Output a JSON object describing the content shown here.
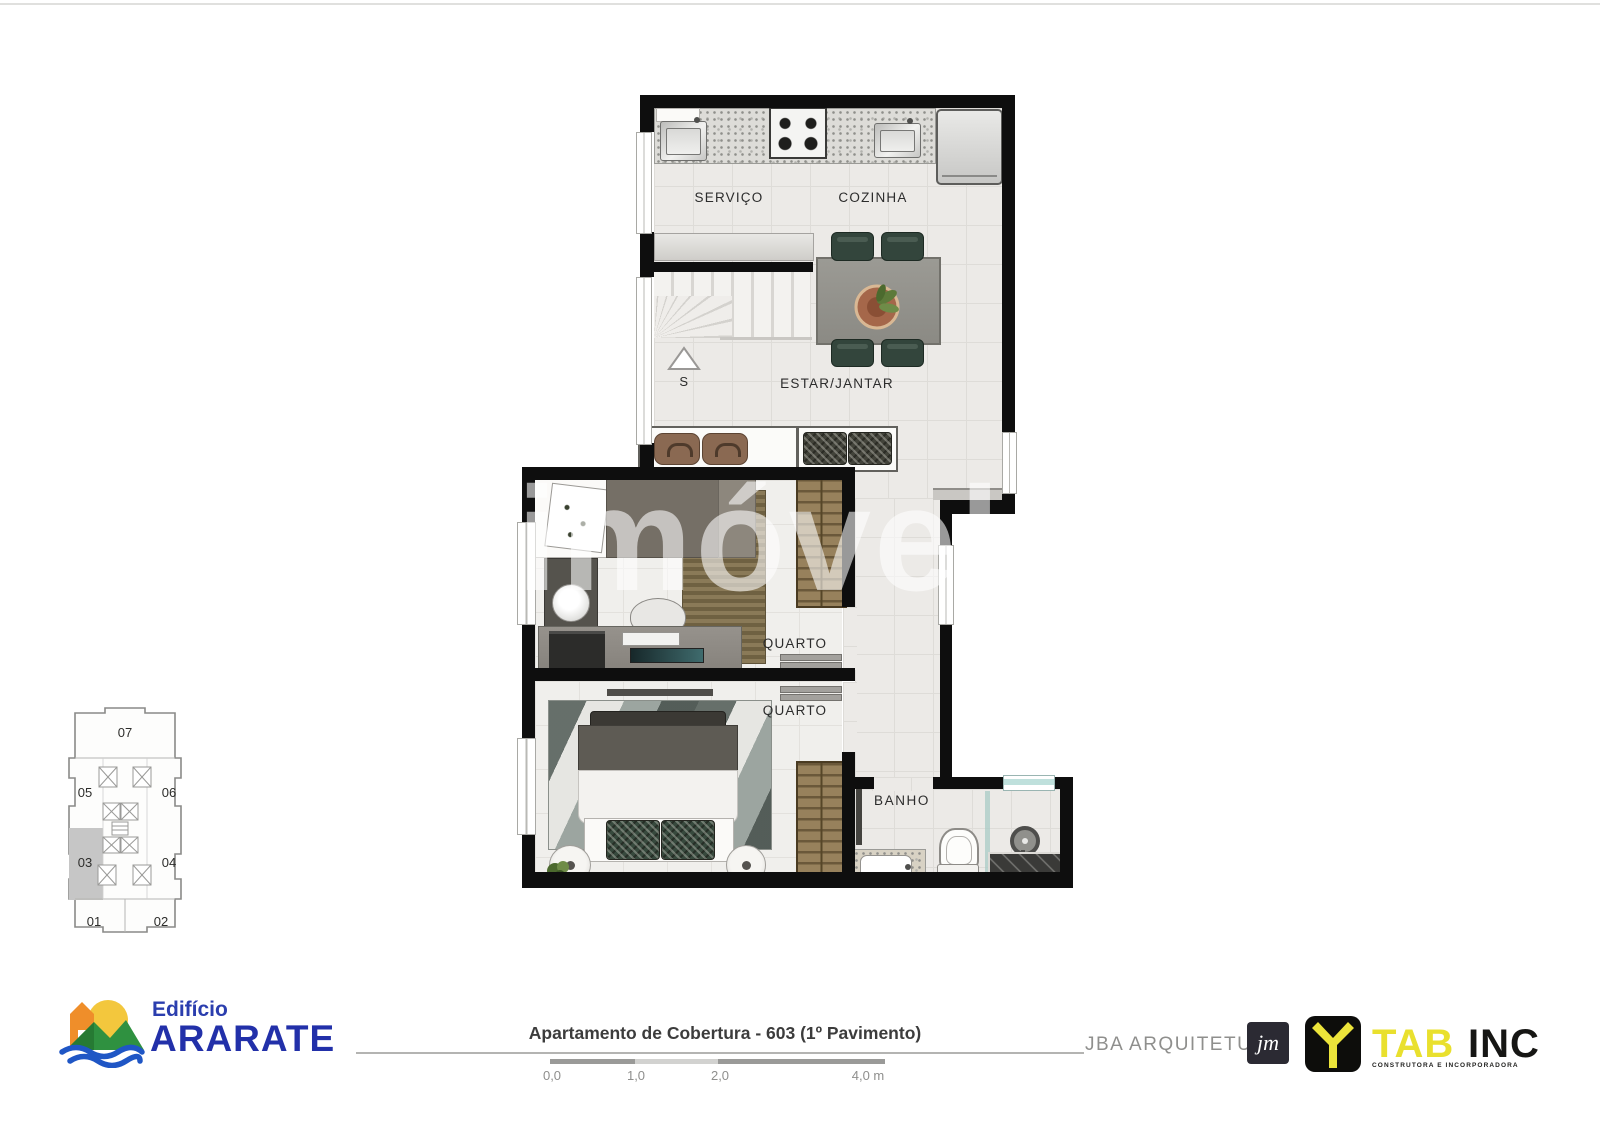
{
  "watermark": {
    "text": "imóvel"
  },
  "plan": {
    "rooms": {
      "servico": "SERVIÇO",
      "cozinha": "COZINHA",
      "estar_jantar": "ESTAR/JANTAR",
      "quarto_1": "QUARTO",
      "quarto_2": "QUARTO",
      "banho": "BANHO"
    },
    "stair_label": "S"
  },
  "keyplan": {
    "highlighted_unit": "03",
    "highlight_color": "#c6c6c6",
    "units": [
      {
        "label": "07"
      },
      {
        "label": "05"
      },
      {
        "label": "06"
      },
      {
        "label": "03"
      },
      {
        "label": "04"
      },
      {
        "label": "01"
      },
      {
        "label": "02"
      }
    ]
  },
  "footer": {
    "title": "Apartamento de Cobertura - 603 (1º Pavimento)",
    "scale_ticks": [
      "0,0",
      "1,0",
      "2,0",
      "4,0 m"
    ],
    "building": {
      "line1": "Edifício",
      "line2": "ARARATE",
      "color": "#2230a9"
    },
    "architect": {
      "name": "JBA ARQUITETURA"
    },
    "developer": {
      "monogram": "jm",
      "brand": "TAB",
      "suffix": "INC",
      "tagline": "CONSTRUTORA E INCORPORADORA",
      "accent_color": "#e9e02e"
    }
  }
}
